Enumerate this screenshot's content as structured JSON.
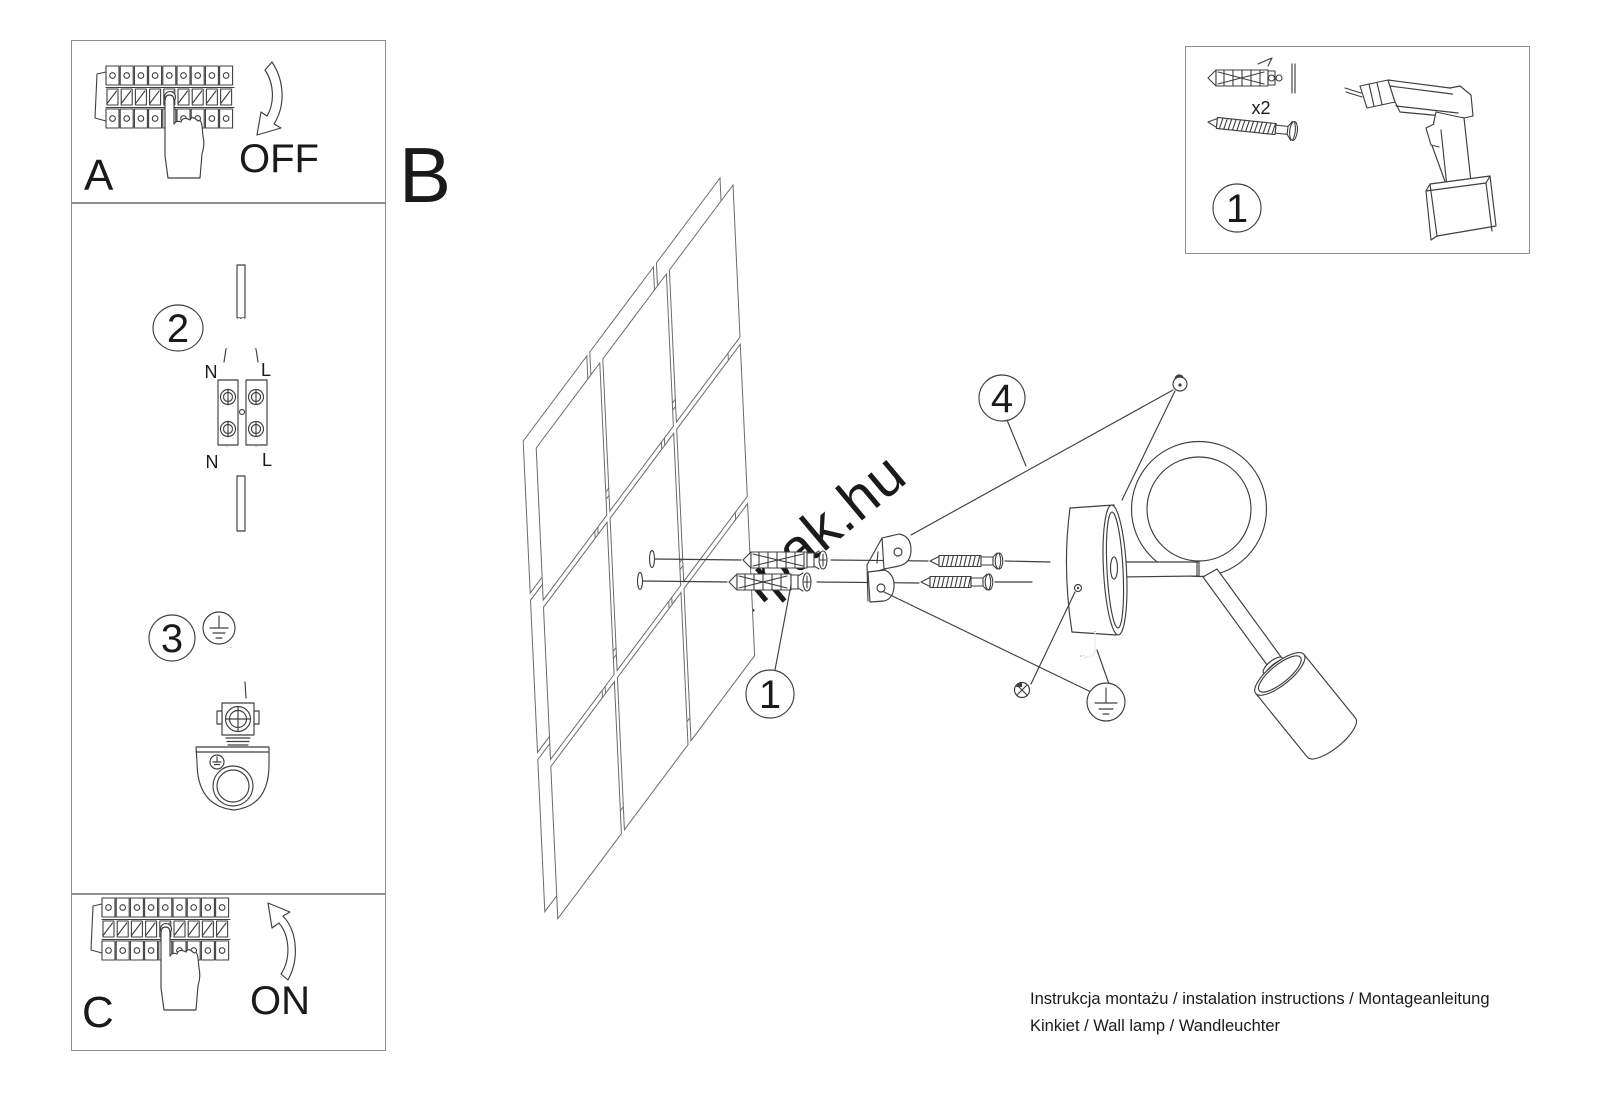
{
  "labels": {
    "panel_off": "A",
    "off": "OFF",
    "section": "B",
    "panel_on": "C",
    "on": "ON"
  },
  "steps": {
    "s1_box": "1",
    "s1_wall": "1",
    "s2": "2",
    "s3": "3",
    "s4": "4",
    "qty": "x2"
  },
  "wiring": {
    "top_n": "N",
    "top_l": "L",
    "bottom_n": "N",
    "bottom_l": "L"
  },
  "footer": {
    "line1": "Instrukcja montażu / instalation instructions / Montageanleitung",
    "line2": "Kinkiet / Wall lamp / Wandleuchter"
  },
  "watermark": "lampak.hu",
  "colors": {
    "line": "#3f3f3f",
    "border": "#8f8f8f",
    "text": "#1a1a1a",
    "watermark": "#d9d9d9"
  }
}
